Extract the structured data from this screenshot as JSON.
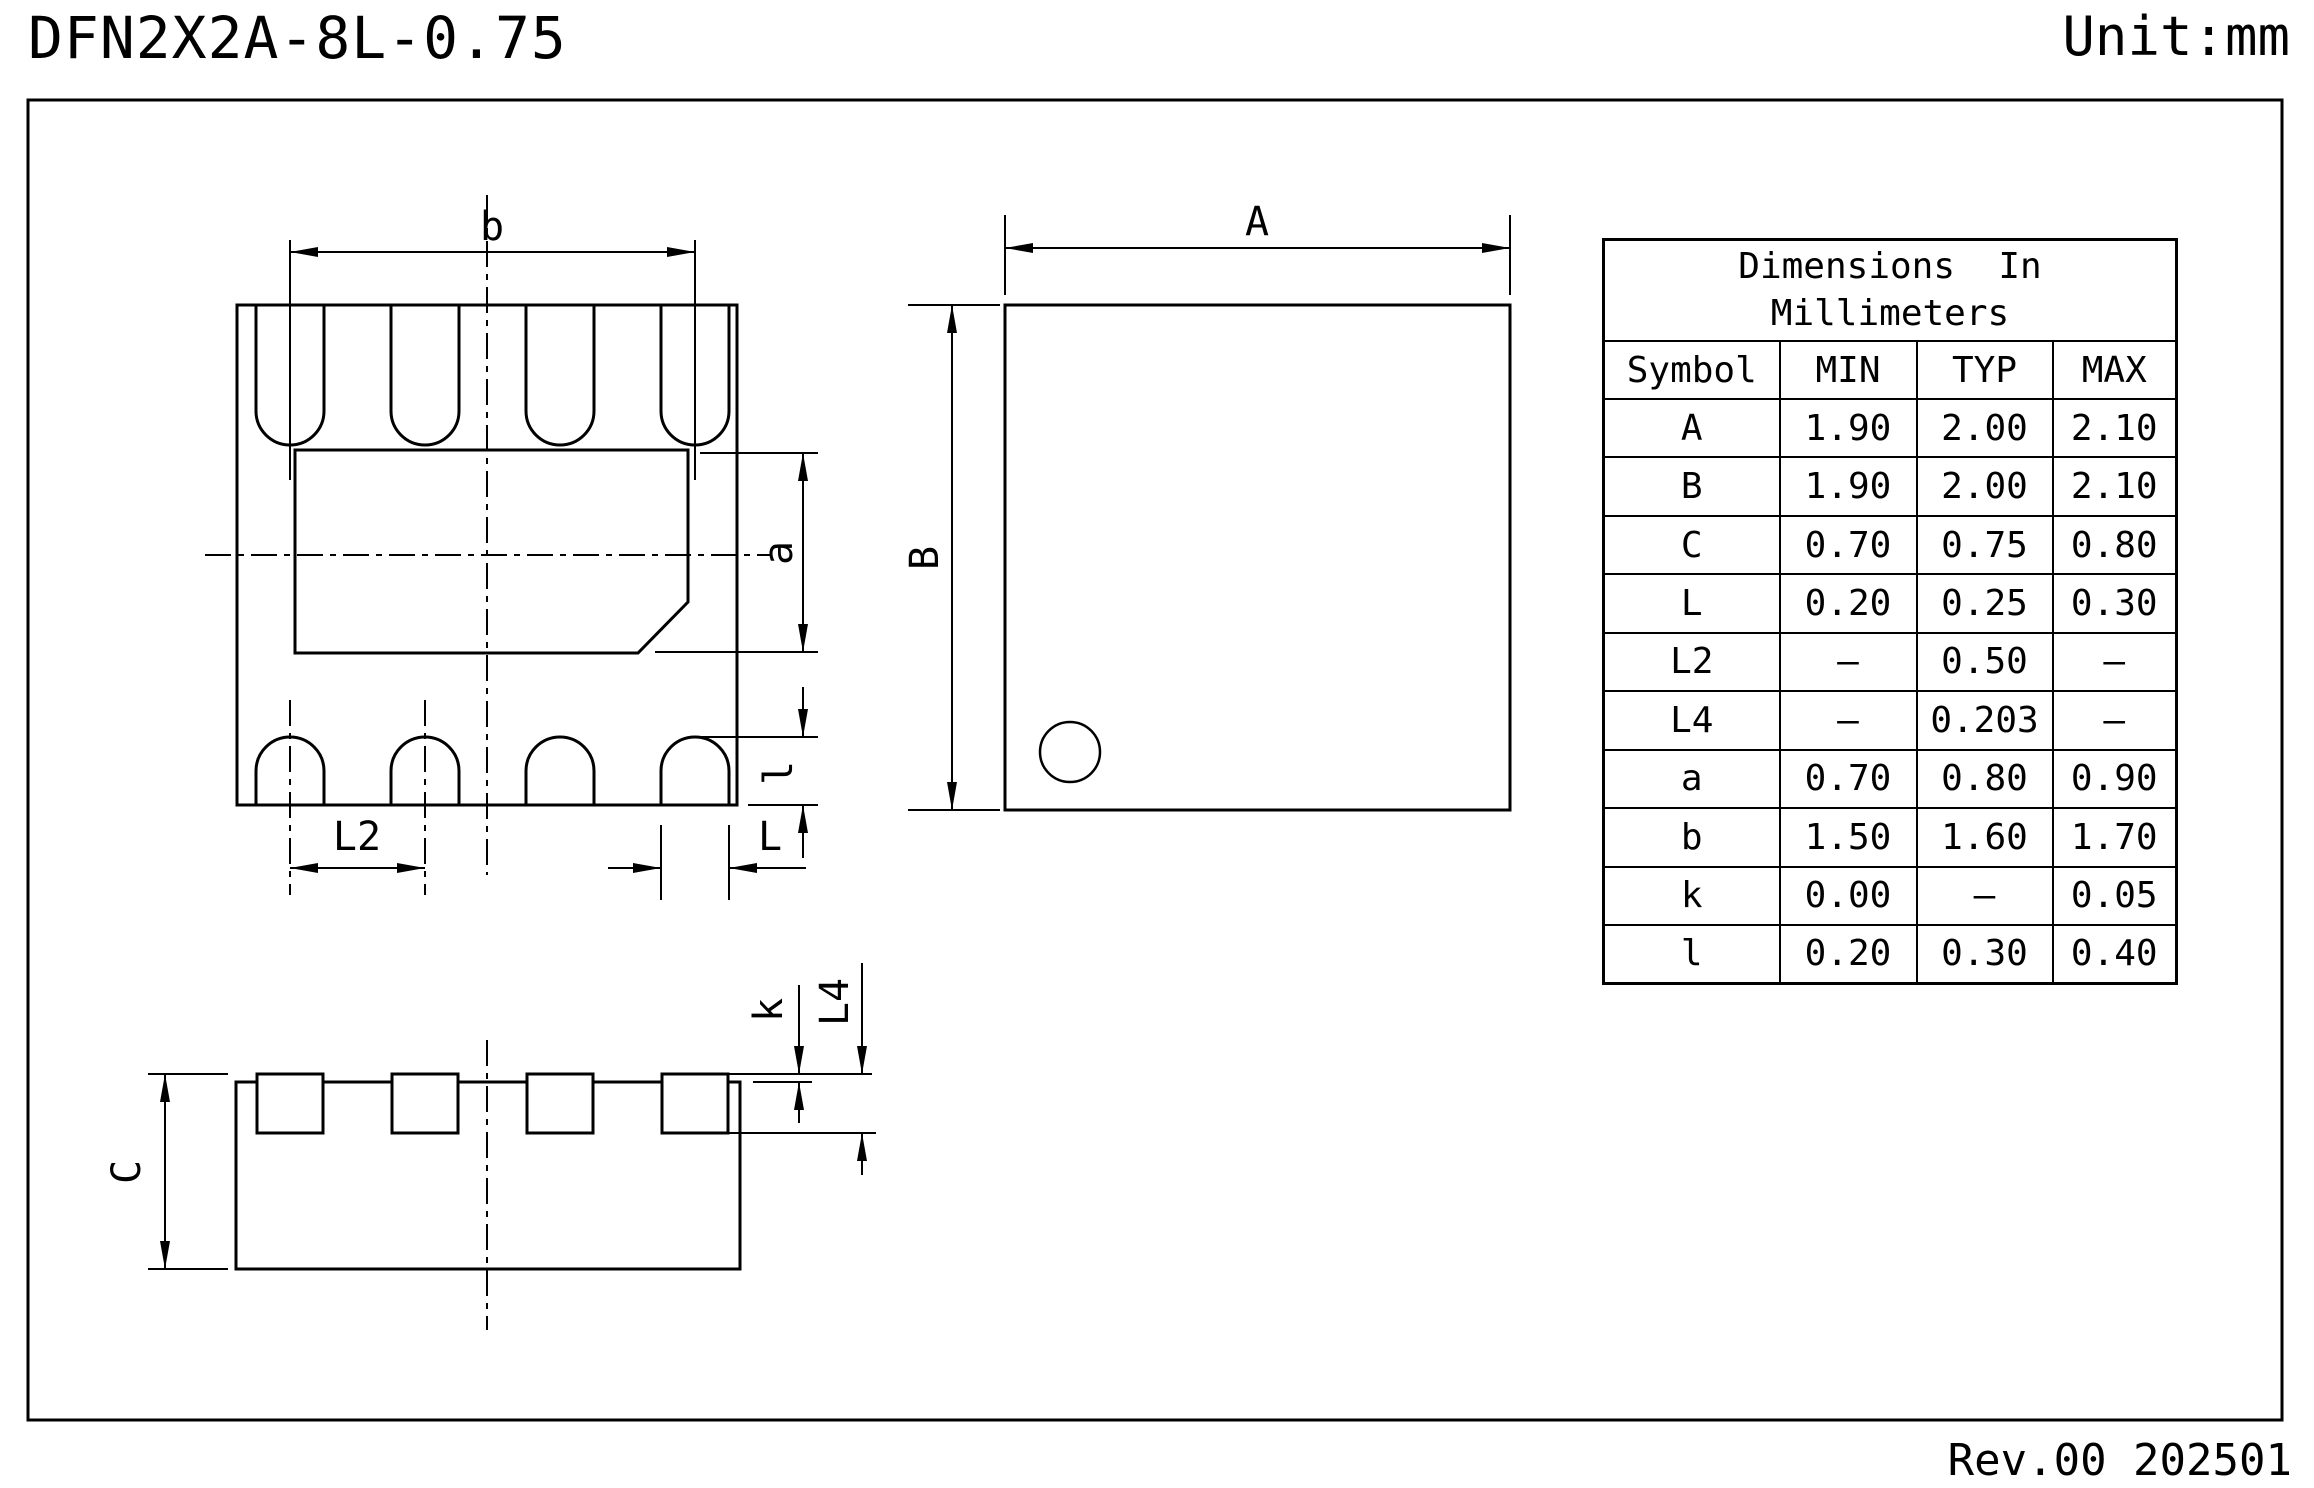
{
  "header": {
    "title": "DFN2X2A-8L-0.75",
    "unit": "Unit:mm"
  },
  "footer": {
    "revision": "Rev.00 202501"
  },
  "dimension_labels": {
    "b": "b",
    "L2": "L2",
    "L": "L",
    "l": "l",
    "a": "a",
    "A": "A",
    "B": "B",
    "C": "C",
    "k": "k",
    "L4": "L4"
  },
  "table": {
    "header_line1": "Dimensions  In",
    "header_line2": "Millimeters",
    "columns": [
      "Symbol",
      "MIN",
      "TYP",
      "MAX"
    ],
    "rows": [
      [
        "A",
        "1.90",
        "2.00",
        "2.10"
      ],
      [
        "B",
        "1.90",
        "2.00",
        "2.10"
      ],
      [
        "C",
        "0.70",
        "0.75",
        "0.80"
      ],
      [
        "L",
        "0.20",
        "0.25",
        "0.30"
      ],
      [
        "L2",
        "–",
        "0.50",
        "–"
      ],
      [
        "L4",
        "–",
        "0.203",
        "–"
      ],
      [
        "a",
        "0.70",
        "0.80",
        "0.90"
      ],
      [
        "b",
        "1.50",
        "1.60",
        "1.70"
      ],
      [
        "k",
        "0.00",
        "–",
        "0.05"
      ],
      [
        "l",
        "0.20",
        "0.30",
        "0.40"
      ]
    ]
  }
}
